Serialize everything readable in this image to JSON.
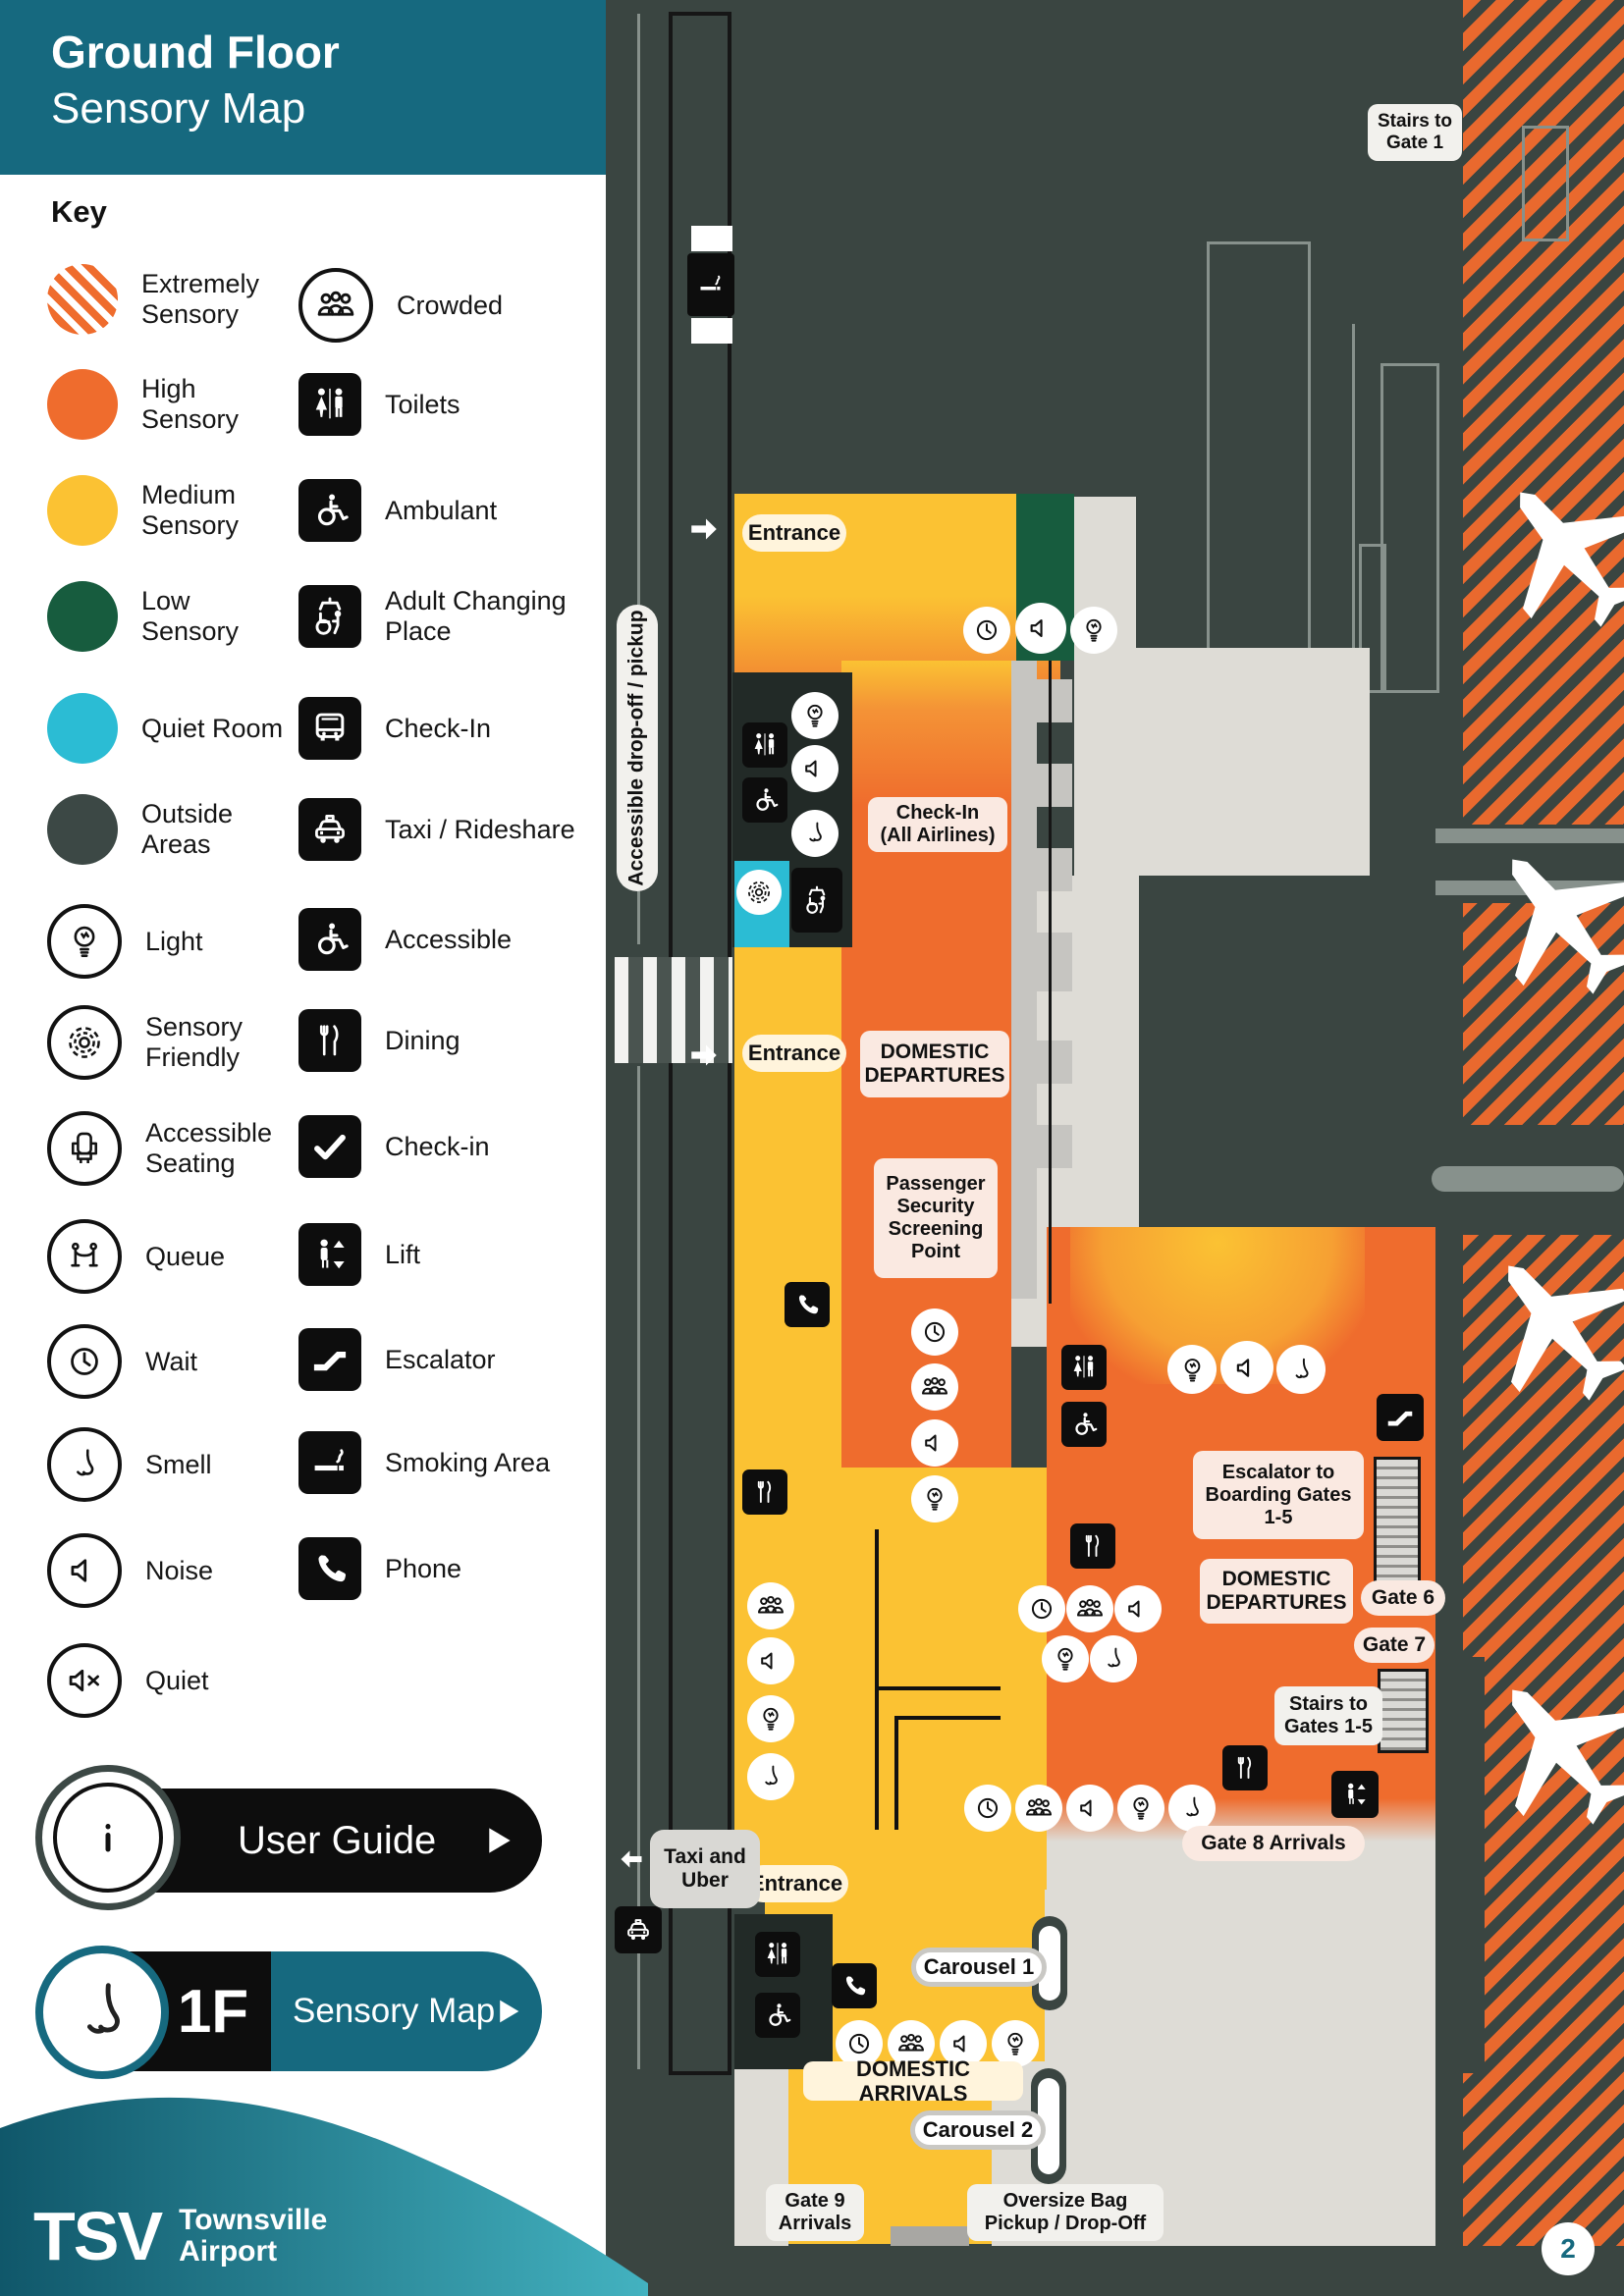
{
  "header": {
    "title_line1": "Ground Floor",
    "title_line2": "Sensory Map"
  },
  "key": {
    "title": "Key",
    "left": [
      {
        "swatch": "extreme",
        "label": "Extremely Sensory"
      },
      {
        "swatch": "high",
        "label": "High Sensory"
      },
      {
        "swatch": "medium",
        "label": "Medium Sensory"
      },
      {
        "swatch": "low",
        "label": "Low Sensory"
      },
      {
        "swatch": "quiet",
        "label": "Quiet Room"
      },
      {
        "swatch": "outside",
        "label": "Outside Areas"
      },
      {
        "icon": "bulb-icon",
        "label": "Light"
      },
      {
        "icon": "flower-icon",
        "label": "Sensory Friendly"
      },
      {
        "icon": "seat-icon",
        "label": "Accessible Seating"
      },
      {
        "icon": "queue-icon",
        "label": "Queue"
      },
      {
        "icon": "clock-icon",
        "label": "Wait"
      },
      {
        "icon": "nose-icon",
        "label": "Smell"
      },
      {
        "icon": "speaker-icon",
        "label": "Noise"
      },
      {
        "icon": "speaker-x-icon",
        "label": "Quiet"
      }
    ],
    "right": [
      {
        "icon": "people-icon",
        "label": "Crowded"
      },
      {
        "icon": "toilets-icon",
        "label": "Toilets"
      },
      {
        "icon": "wheelchair-icon",
        "label": "Ambulant"
      },
      {
        "icon": "adult-change-icon",
        "label": "Adult Changing Place"
      },
      {
        "icon": "bus-icon",
        "label": "Check-In"
      },
      {
        "icon": "taxi-icon",
        "label": "Taxi / Rideshare"
      },
      {
        "icon": "wheelchair-icon",
        "label": "Accessible"
      },
      {
        "icon": "dining-icon",
        "label": "Dining"
      },
      {
        "icon": "check-icon",
        "label": "Check-in"
      },
      {
        "icon": "lift-icon",
        "label": "Lift"
      },
      {
        "icon": "escalator-icon",
        "label": "Escalator"
      },
      {
        "icon": "smoking-icon",
        "label": "Smoking Area"
      },
      {
        "icon": "phone-icon",
        "label": "Phone"
      }
    ]
  },
  "buttons": {
    "user_guide": "User Guide",
    "floor_code": "1F",
    "floor_map": "Sensory Map"
  },
  "map": {
    "labels": {
      "stairs_gate1": "Stairs to\nGate 1",
      "entrance": "Entrance",
      "dropoff": "Accessible drop-off / pickup",
      "checkin_all": "Check-In\n(All Airlines)",
      "domestic_departures": "DOMESTIC\nDEPARTURES",
      "security": "Passenger\nSecurity\nScreening\nPoint",
      "escalator_gates": "Escalator to\nBoarding Gates\n1-5",
      "gate6": "Gate 6",
      "gate7": "Gate 7",
      "stairs_gates15": "Stairs to\nGates 1-5",
      "gate8": "Gate 8 Arrivals",
      "taxi_uber": "Taxi and\nUber",
      "carousel1": "Carousel 1",
      "domestic_arrivals": "DOMESTIC ARRIVALS",
      "carousel2": "Carousel 2",
      "gate9": "Gate 9\nArrivals",
      "oversize": "Oversize Bag\nPickup / Drop-Off"
    }
  },
  "footer": {
    "logo": "TSV",
    "airport_line1": "Townsville",
    "airport_line2": "Airport",
    "page": "2"
  },
  "colors": {
    "teal_header": "#16697F",
    "high_sensory": "#EF6C2D",
    "medium_sensory": "#FBC233",
    "low_sensory": "#175C3E",
    "quiet_room": "#2BBCD4",
    "outside": "#3A4541",
    "floor_gray": "#DEDCD6"
  }
}
